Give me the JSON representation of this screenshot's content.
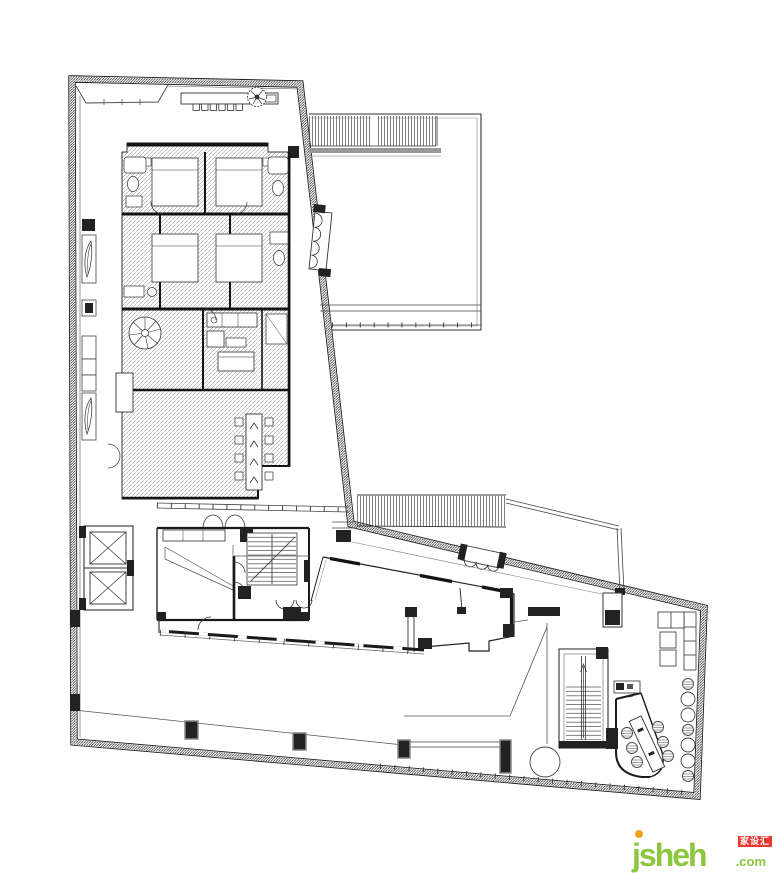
{
  "page": {
    "background": "#ffffff",
    "width": 780,
    "height": 873
  },
  "watermark": {
    "brand": "jsheh",
    "tld": ".com",
    "badge": "家设汇",
    "brand_color": "#8dc63f",
    "dot_color": "#f5a21b",
    "badge_bg": "#e8382f",
    "badge_text_color": "#ffffff"
  },
  "plan": {
    "description": "Architectural floor plan, black line drawing on white with hatched room block",
    "line_color": "#1c1c1c",
    "hatch_color": "#707070",
    "louver_gray": "#999999",
    "features": {
      "elevators": 2,
      "entrance_door_arcs": 2,
      "folding_door_leaves_upper_wall": 4,
      "folding_door_leaves_mid_wall": 3,
      "dining_chairs": 8,
      "meeting_chairs": 6,
      "bar_stools": 7,
      "garden_columns": 3,
      "planter_leaves": 2,
      "stair_flights": 3,
      "round_tables": 1,
      "louver_bands": 2,
      "top_terrace_seats": 6
    }
  }
}
